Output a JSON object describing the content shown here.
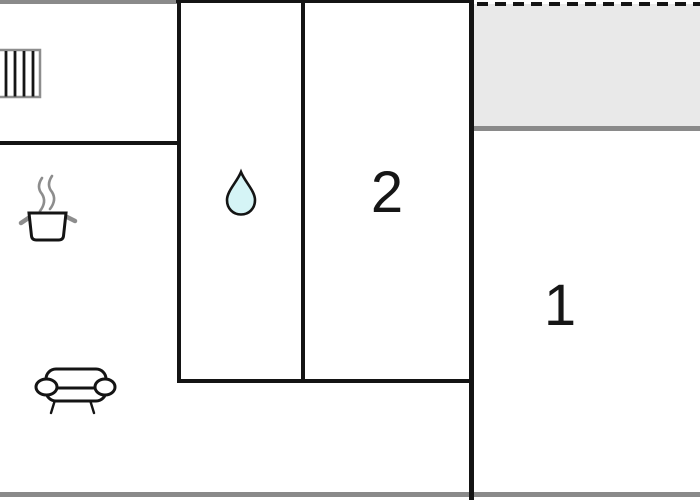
{
  "floorplan": {
    "rooms": [
      {
        "label": "1"
      },
      {
        "label": "2"
      }
    ],
    "icons": [
      {
        "name": "radiator-icon"
      },
      {
        "name": "cooking-pot-icon"
      },
      {
        "name": "water-drop-icon"
      },
      {
        "name": "sofa-icon"
      }
    ],
    "colors": {
      "background": "#ffffff",
      "wall_black": "#141414",
      "wall_gray": "#8a8a8a",
      "terrace_fill": "#e9e9e9",
      "drop_fill": "#d5f4f6",
      "icon_gray": "#8d8d8d"
    }
  }
}
